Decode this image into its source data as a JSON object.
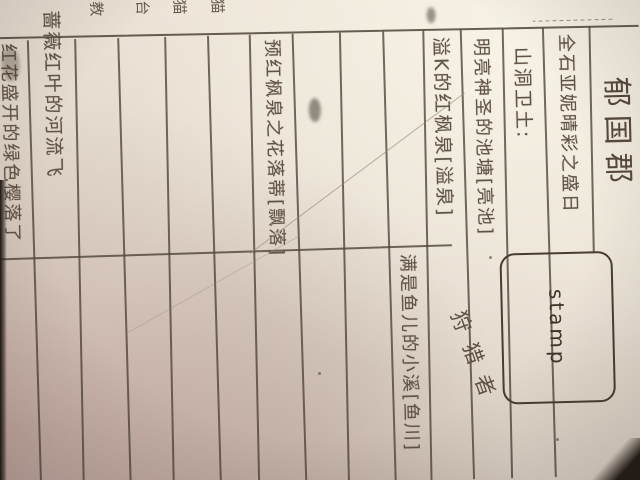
{
  "document": {
    "title": "郁国郡",
    "stamp_label": "stamp",
    "diagonal_note": "狩猎者",
    "margin_notes": [
      "猫",
      "猫",
      "台",
      "教"
    ],
    "rows": [
      {
        "text": "全石亚妮晴彩之盛日"
      },
      {
        "text": "山洞卫土:"
      },
      {
        "text": "明亮神圣的池塘[亮池]"
      },
      {
        "text": "溢K的红枫泉[溢泉]"
      },
      {
        "text": "满是鱼儿的小溪[鱼川]"
      },
      {
        "text": ""
      },
      {
        "text": ""
      },
      {
        "text": "预红枫泉之花落蒂[飘落]"
      },
      {
        "text": ""
      },
      {
        "text": ""
      },
      {
        "text": ""
      },
      {
        "text": ""
      },
      {
        "text": "蔷薇红叶的河流飞"
      },
      {
        "text": "红花盛开的绿色樱落了"
      }
    ],
    "colors": {
      "paper": "#e9e1d4",
      "pencil": "#50453a",
      "desk": "#1c1612"
    }
  }
}
